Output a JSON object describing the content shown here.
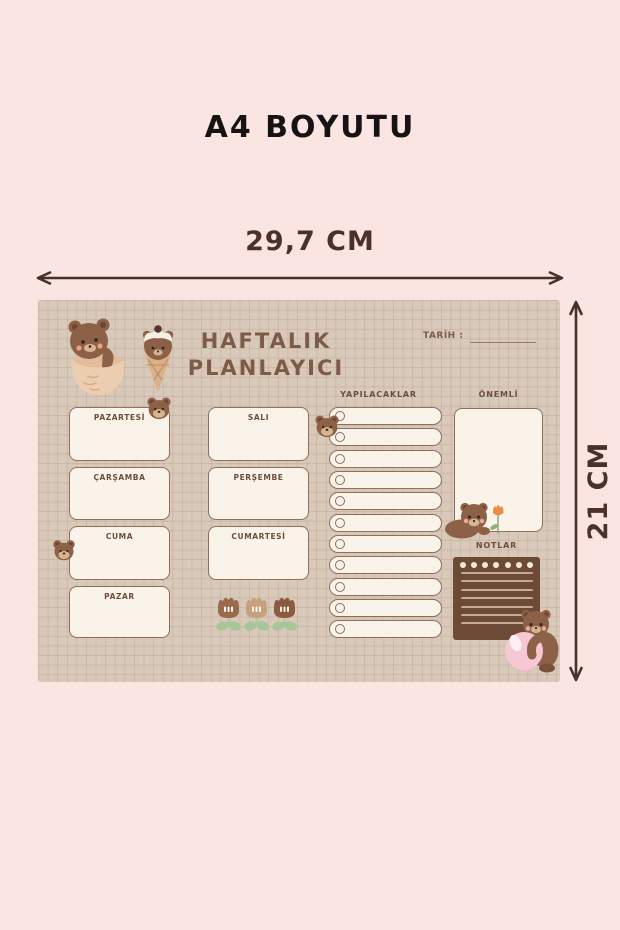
{
  "page": {
    "title": "A4 BOYUTU",
    "background_color": "#fbe5e2"
  },
  "dimension_annotations": {
    "width_label": "29,7 CM",
    "height_label": "21 CM",
    "arrow_color": "#46302a"
  },
  "planner": {
    "title_line1": "HAFTALIK",
    "title_line2": "PLANLAYICI",
    "date_label": "TARİH :",
    "todo_header": "YAPILACAKLAR",
    "important_header": "ÖNEMLİ",
    "notes_header": "NOTLAR",
    "days_left": [
      "PAZARTESİ",
      "ÇARŞAMBA",
      "CUMA",
      "PAZAR"
    ],
    "days_middle": [
      "SALI",
      "PERŞEMBE",
      "CUMARTESİ"
    ],
    "todo_row_count": 11,
    "notepad": {
      "hole_count": 7,
      "line_count": 7
    },
    "colors": {
      "paper_bg": "#d9c9ba",
      "grid_line": "#a88e74",
      "card_fill": "#faf3e9",
      "card_border": "#8d6f5a",
      "heading_text": "#7d5b49",
      "label_text": "#6d4e3d",
      "notepad_fill": "#6d4a36",
      "notepad_line": "#c3ab94",
      "bear_brown": "#8d6147",
      "tulip_green": "#a9c69a",
      "balloon_pink": "#f5c8d3",
      "flower_orange": "#ea8c4a"
    },
    "decorations": [
      "bear-in-cup-icon",
      "ice-cream-bear-icon",
      "bear-head-sticker-icon",
      "tulip-icon",
      "bear-with-flower-icon",
      "bear-with-balloon-icon"
    ]
  }
}
